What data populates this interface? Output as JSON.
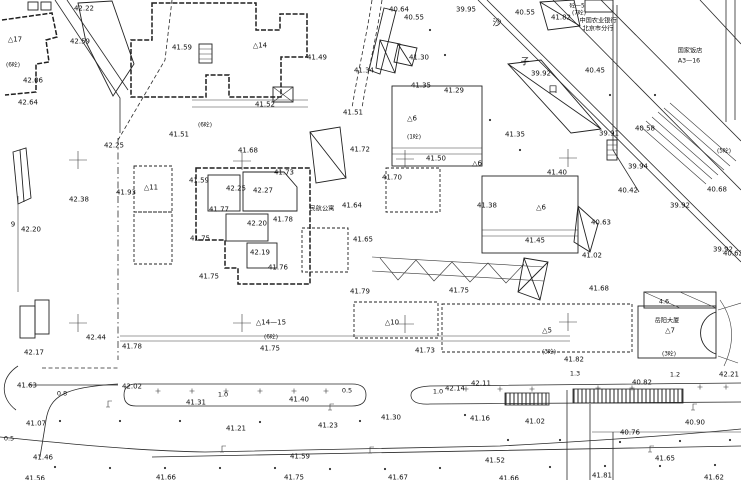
{
  "meta": {
    "type": "topographic-survey-plan",
    "paper": "#ffffff",
    "ink": "#1c1c1c"
  },
  "spot_elevations": [
    {
      "t": "42.22",
      "x": 84,
      "y": 8
    },
    {
      "t": "42.59",
      "x": 80,
      "y": 41
    },
    {
      "t": "41.59",
      "x": 182,
      "y": 47
    },
    {
      "t": "42.06",
      "x": 33,
      "y": 80
    },
    {
      "t": "42.64",
      "x": 28,
      "y": 102
    },
    {
      "t": "40.64",
      "x": 399,
      "y": 9
    },
    {
      "t": "40.55",
      "x": 414,
      "y": 17
    },
    {
      "t": "39.95",
      "x": 466,
      "y": 9
    },
    {
      "t": "40.55",
      "x": 525,
      "y": 12
    },
    {
      "t": "41.82",
      "x": 561,
      "y": 17
    },
    {
      "t": "40.45",
      "x": 595,
      "y": 70
    },
    {
      "t": "39.92",
      "x": 541,
      "y": 73
    },
    {
      "t": "41.49",
      "x": 317,
      "y": 57
    },
    {
      "t": "41.52",
      "x": 265,
      "y": 104
    },
    {
      "t": "41.51",
      "x": 353,
      "y": 112
    },
    {
      "t": "41.30",
      "x": 419,
      "y": 57
    },
    {
      "t": "41.34",
      "x": 364,
      "y": 70
    },
    {
      "t": "41.35",
      "x": 421,
      "y": 85
    },
    {
      "t": "41.29",
      "x": 454,
      "y": 90
    },
    {
      "t": "41.35",
      "x": 515,
      "y": 134
    },
    {
      "t": "41.50",
      "x": 436,
      "y": 158
    },
    {
      "t": "41.70",
      "x": 392,
      "y": 177
    },
    {
      "t": "41.40",
      "x": 557,
      "y": 172
    },
    {
      "t": "41.38",
      "x": 487,
      "y": 205
    },
    {
      "t": "41.45",
      "x": 535,
      "y": 240
    },
    {
      "t": "40.63",
      "x": 601,
      "y": 222
    },
    {
      "t": "40.58",
      "x": 645,
      "y": 128
    },
    {
      "t": "39.91",
      "x": 609,
      "y": 133
    },
    {
      "t": "39.94",
      "x": 638,
      "y": 166
    },
    {
      "t": "40.42",
      "x": 628,
      "y": 190
    },
    {
      "t": "40.68",
      "x": 717,
      "y": 189
    },
    {
      "t": "39.92",
      "x": 680,
      "y": 205
    },
    {
      "t": "39.92",
      "x": 723,
      "y": 249
    },
    {
      "t": "42.25",
      "x": 114,
      "y": 145
    },
    {
      "t": "41.51",
      "x": 179,
      "y": 134
    },
    {
      "t": "41.68",
      "x": 248,
      "y": 150
    },
    {
      "t": "41.73",
      "x": 284,
      "y": 172
    },
    {
      "t": "41.59",
      "x": 199,
      "y": 180
    },
    {
      "t": "42.25",
      "x": 236,
      "y": 188
    },
    {
      "t": "42.27",
      "x": 263,
      "y": 190
    },
    {
      "t": "41.93",
      "x": 126,
      "y": 192
    },
    {
      "t": "42.38",
      "x": 79,
      "y": 199
    },
    {
      "t": "41.77",
      "x": 219,
      "y": 209
    },
    {
      "t": "42.20",
      "x": 257,
      "y": 223
    },
    {
      "t": "41.78",
      "x": 283,
      "y": 219
    },
    {
      "t": "42.20",
      "x": 31,
      "y": 229
    },
    {
      "t": "41.75",
      "x": 200,
      "y": 238
    },
    {
      "t": "42.19",
      "x": 260,
      "y": 252
    },
    {
      "t": "41.76",
      "x": 278,
      "y": 267
    },
    {
      "t": "41.75",
      "x": 209,
      "y": 276
    },
    {
      "t": "41.72",
      "x": 360,
      "y": 149
    },
    {
      "t": "41.64",
      "x": 352,
      "y": 205
    },
    {
      "t": "41.65",
      "x": 363,
      "y": 239
    },
    {
      "t": "41.02",
      "x": 592,
      "y": 255
    },
    {
      "t": "41.68",
      "x": 599,
      "y": 288
    },
    {
      "t": "41.79",
      "x": 360,
      "y": 291
    },
    {
      "t": "41.75",
      "x": 459,
      "y": 290
    },
    {
      "t": "41.75",
      "x": 270,
      "y": 348
    },
    {
      "t": "41.73",
      "x": 425,
      "y": 350
    },
    {
      "t": "41.82",
      "x": 574,
      "y": 359
    },
    {
      "t": "42.44",
      "x": 96,
      "y": 337
    },
    {
      "t": "42.17",
      "x": 34,
      "y": 352
    },
    {
      "t": "41.78",
      "x": 132,
      "y": 346
    },
    {
      "t": "41.63",
      "x": 27,
      "y": 385
    },
    {
      "t": "42.02",
      "x": 132,
      "y": 386
    },
    {
      "t": "41.31",
      "x": 196,
      "y": 402
    },
    {
      "t": "41.07",
      "x": 36,
      "y": 423
    },
    {
      "t": "41.21",
      "x": 236,
      "y": 428
    },
    {
      "t": "41.46",
      "x": 43,
      "y": 457
    },
    {
      "t": "41.56",
      "x": 35,
      "y": 478
    },
    {
      "t": "41.66",
      "x": 166,
      "y": 477
    },
    {
      "t": "41.40",
      "x": 299,
      "y": 399
    },
    {
      "t": "41.23",
      "x": 328,
      "y": 425
    },
    {
      "t": "41.30",
      "x": 391,
      "y": 417
    },
    {
      "t": "42.14",
      "x": 455,
      "y": 388
    },
    {
      "t": "42.11",
      "x": 481,
      "y": 383
    },
    {
      "t": "41.16",
      "x": 480,
      "y": 418
    },
    {
      "t": "41.59",
      "x": 300,
      "y": 456
    },
    {
      "t": "41.75",
      "x": 294,
      "y": 477
    },
    {
      "t": "41.67",
      "x": 398,
      "y": 477
    },
    {
      "t": "40.82",
      "x": 642,
      "y": 382
    },
    {
      "t": "41.02",
      "x": 535,
      "y": 421
    },
    {
      "t": "40.90",
      "x": 695,
      "y": 422
    },
    {
      "t": "40.76",
      "x": 630,
      "y": 432
    },
    {
      "t": "41.65",
      "x": 665,
      "y": 458
    },
    {
      "t": "41.81",
      "x": 602,
      "y": 475
    },
    {
      "t": "41.62",
      "x": 714,
      "y": 477
    },
    {
      "t": "41.52",
      "x": 495,
      "y": 460
    },
    {
      "t": "42.21",
      "x": 729,
      "y": 374
    },
    {
      "t": "40.62",
      "x": 733,
      "y": 253
    },
    {
      "t": "41.66",
      "x": 509,
      "y": 478
    }
  ],
  "dimensions": [
    {
      "t": "0.8",
      "x": 62,
      "y": 393
    },
    {
      "t": "1.0",
      "x": 223,
      "y": 394
    },
    {
      "t": "0.5",
      "x": 347,
      "y": 390
    },
    {
      "t": "1.0",
      "x": 438,
      "y": 391
    },
    {
      "t": "1.3",
      "x": 575,
      "y": 373
    },
    {
      "t": "1.2",
      "x": 675,
      "y": 374
    },
    {
      "t": "0.5",
      "x": 9,
      "y": 438
    },
    {
      "t": "4.6",
      "x": 664,
      "y": 301
    }
  ],
  "building_ids": [
    {
      "t": "△17",
      "x": 15,
      "y": 39
    },
    {
      "t": "△14",
      "x": 260,
      "y": 45
    },
    {
      "t": "△11",
      "x": 151,
      "y": 187
    },
    {
      "t": "△6",
      "x": 412,
      "y": 118
    },
    {
      "t": "△6",
      "x": 477,
      "y": 163
    },
    {
      "t": "△6",
      "x": 541,
      "y": 207
    },
    {
      "t": "△10",
      "x": 392,
      "y": 322
    },
    {
      "t": "△14—15",
      "x": 271,
      "y": 322
    },
    {
      "t": "△5",
      "x": 547,
      "y": 330
    },
    {
      "t": "△7",
      "x": 670,
      "y": 330
    },
    {
      "t": "9",
      "x": 13,
      "y": 224
    }
  ],
  "story_tags": [
    {
      "t": "(6砼)",
      "x": 13,
      "y": 64
    },
    {
      "t": "(6砼)",
      "x": 205,
      "y": 124
    },
    {
      "t": "砼—5",
      "x": 577,
      "y": 5
    },
    {
      "t": "(7砼)",
      "x": 579,
      "y": 12
    },
    {
      "t": "(1砼)",
      "x": 414,
      "y": 136
    },
    {
      "t": "(6砼)",
      "x": 271,
      "y": 336
    },
    {
      "t": "(3砼)",
      "x": 549,
      "y": 351
    },
    {
      "t": "(3砼)",
      "x": 669,
      "y": 353
    },
    {
      "t": "(5砼)",
      "x": 724,
      "y": 150
    }
  ],
  "notes": [
    {
      "t": "中国农业银行",
      "x": 598,
      "y": 20
    },
    {
      "t": "北京市分行",
      "x": 598,
      "y": 28
    },
    {
      "t": "国家饭店",
      "x": 690,
      "y": 50
    },
    {
      "t": "A3—16",
      "x": 689,
      "y": 60
    },
    {
      "t": "民航公寓",
      "x": 322,
      "y": 208
    },
    {
      "t": "岳阳大厦",
      "x": 667,
      "y": 320
    }
  ],
  "street_chars": [
    {
      "t": "沙",
      "x": 497,
      "y": 23
    },
    {
      "t": "子",
      "x": 525,
      "y": 62
    },
    {
      "t": "口",
      "x": 553,
      "y": 90
    }
  ],
  "crosses": [
    [
      78,
      160
    ],
    [
      242,
      161
    ],
    [
      405,
      159
    ],
    [
      568,
      158
    ],
    [
      78,
      323
    ],
    [
      242,
      323
    ],
    [
      405,
      324
    ],
    [
      568,
      322
    ]
  ],
  "symbols": {
    "lamps": [
      [
        108,
        401
      ],
      [
        330,
        404
      ],
      [
        222,
        446
      ],
      [
        370,
        447
      ],
      [
        650,
        446
      ],
      [
        693,
        404
      ]
    ],
    "plus_marks": [
      [
        158,
        391
      ],
      [
        192,
        391
      ],
      [
        226,
        391
      ],
      [
        260,
        391
      ],
      [
        294,
        391
      ],
      [
        326,
        391
      ],
      [
        466,
        389
      ],
      [
        500,
        389
      ],
      [
        532,
        389
      ],
      [
        598,
        388
      ],
      [
        632,
        388
      ],
      [
        700,
        387
      ],
      [
        726,
        387
      ]
    ],
    "dots": [
      [
        60,
        421
      ],
      [
        120,
        421
      ],
      [
        180,
        421
      ],
      [
        260,
        422
      ],
      [
        360,
        421
      ],
      [
        465,
        415
      ],
      [
        55,
        467
      ],
      [
        110,
        468
      ],
      [
        165,
        468
      ],
      [
        220,
        468
      ],
      [
        275,
        468
      ],
      [
        330,
        469
      ],
      [
        385,
        469
      ],
      [
        440,
        468
      ],
      [
        550,
        467
      ],
      [
        605,
        466
      ],
      [
        660,
        466
      ],
      [
        715,
        465
      ],
      [
        508,
        440
      ],
      [
        560,
        440
      ],
      [
        620,
        442
      ],
      [
        680,
        441
      ],
      [
        730,
        440
      ],
      [
        430,
        30
      ],
      [
        445,
        55
      ],
      [
        490,
        120
      ],
      [
        520,
        150
      ],
      [
        610,
        95
      ],
      [
        655,
        95
      ]
    ]
  }
}
